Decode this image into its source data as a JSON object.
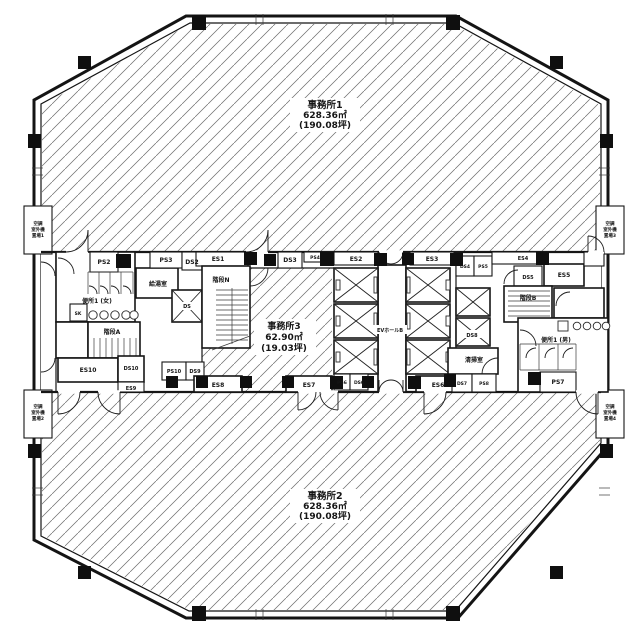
{
  "offices": [
    {
      "name": "事務所1",
      "area": "628.36㎡",
      "tsubo": "(190.08坪)"
    },
    {
      "name": "事務所2",
      "area": "628.36㎡",
      "tsubo": "(190.08坪)"
    },
    {
      "name": "事務所3",
      "area": "62.90㎡",
      "tsubo": "(19.03坪)"
    }
  ],
  "rooms": {
    "stair_a": "階段A",
    "stair_n": "階段N",
    "stair_b": "階段B",
    "kitchen": "給湯室",
    "cleaning": "清掃室",
    "toilet_w": "便所1 (女)",
    "toilet_m": "便所1 (男)",
    "ev_hall": "EVホールB",
    "sk": "SK"
  },
  "shafts": {
    "ps2": "PS2",
    "ps3": "PS3",
    "ps4": "PS4",
    "ps5": "PS5",
    "ps6": "PS6",
    "ps7": "PS7",
    "ps8": "PS8",
    "ps10": "PS10",
    "ds1": "DS",
    "ds2": "DS2",
    "ds3": "DS3",
    "ds4": "DS4",
    "ds5": "DS5",
    "ds6": "DS6",
    "ds7": "DS7",
    "ds8": "DS8",
    "ds9": "DS9",
    "ds10": "DS10",
    "es1": "ES1",
    "es2": "ES2",
    "es3": "ES3",
    "es4": "ES4",
    "es5": "ES5",
    "es6": "ES6",
    "es7": "ES7",
    "es8": "ES8",
    "es9": "ES9",
    "es10": "ES10"
  },
  "ac_bays": [
    {
      "l1": "空調",
      "l2": "室外機",
      "l3": "置場1"
    },
    {
      "l1": "空調",
      "l2": "室外機",
      "l3": "置場2"
    },
    {
      "l1": "空調",
      "l2": "室外機",
      "l3": "置場3"
    },
    {
      "l1": "空調",
      "l2": "室外機",
      "l3": "置場4"
    }
  ]
}
